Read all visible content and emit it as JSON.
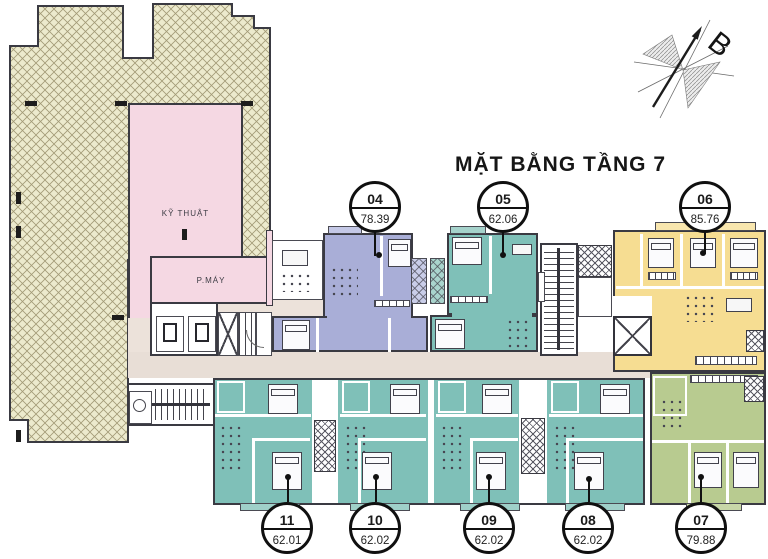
{
  "title": "MẶT BẰNG TẦNG 7",
  "compass": {
    "label": "B"
  },
  "rooms": {
    "technical": "KỸ THUẬT",
    "machine": "P.MÁY"
  },
  "units": [
    {
      "no": "04",
      "area": "78.39",
      "color": "#a9aed7"
    },
    {
      "no": "05",
      "area": "62.06",
      "color": "#7fc0b8"
    },
    {
      "no": "06",
      "area": "85.76",
      "color": "#f6dd92"
    },
    {
      "no": "07",
      "area": "79.88",
      "color": "#b8cb90"
    },
    {
      "no": "08",
      "area": "62.02",
      "color": "#7fc0b8"
    },
    {
      "no": "09",
      "area": "62.02",
      "color": "#7fc0b8"
    },
    {
      "no": "10",
      "area": "62.02",
      "color": "#7fc0b8"
    },
    {
      "no": "11",
      "area": "62.01",
      "color": "#7fc0b8"
    }
  ],
  "colors": {
    "terrace": "#eceacd",
    "technical_room": "#f5d8e3",
    "corridor": "#e8ded6",
    "walls": "#3a3a42"
  }
}
